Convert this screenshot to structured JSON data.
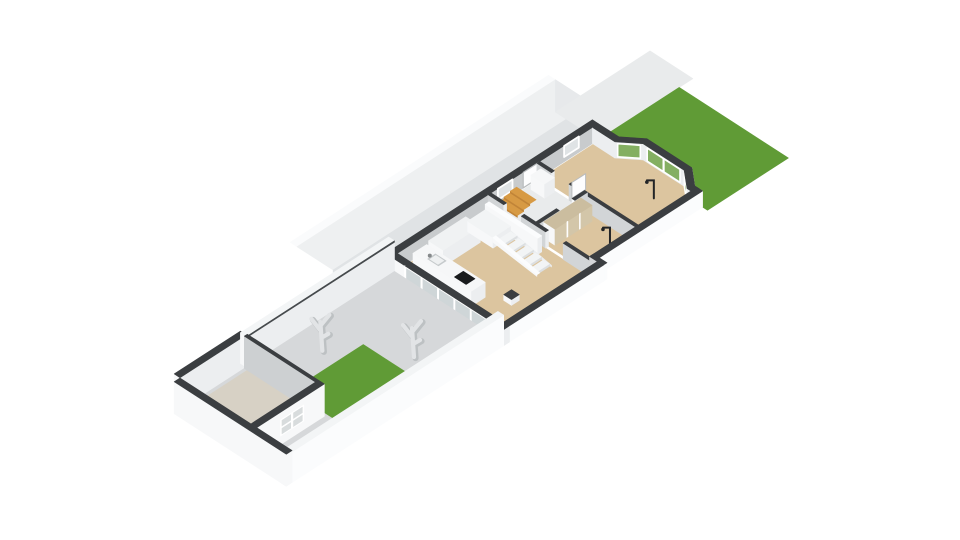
{
  "view": {
    "type": "floorplan-3d-axonometric",
    "background": "#ffffff",
    "projection": "isometric"
  },
  "scene": {
    "trees": 2,
    "gardens": 2
  },
  "palette": {
    "bg": "#ffffff",
    "wallTop": "#3b3e41",
    "wallWhite": "#f7f8f9",
    "wallBright": "#fbfcfd",
    "wallLight": "#eceef0",
    "wallShade": "#d8dadc",
    "wallInterior": "#c8cbcd",
    "wallInteriorLight": "#d2d5d7",
    "floorWood": "#dcc59f",
    "floorShed": "#d7d1c5",
    "floorBath": "#e9ebec",
    "paving": "#d6d8da",
    "lawn": "#609b36",
    "glass": "#cfd6d8",
    "glassPale": "#dfe3e5",
    "glassGreen": "#84af62",
    "shedGlass": "#d8dcdd",
    "counterTop": "#f6f7f8",
    "cabinetTop": "#f0f2f3",
    "cooktop": "#191b1d",
    "sink": "#c6cacc",
    "sinkInner": "#eef0f1",
    "faucet": "#85898b",
    "stairWood": "#d79a44",
    "stairWoodDark": "#c08438",
    "tread": "#f2f4f5",
    "riser": "#dcdfe1",
    "wardrobe": "#d3c6a9",
    "wardrobeTop": "#cbbd9f",
    "roofBand": "#eef0f1",
    "roofFace": "#e0e3e5",
    "roofCap": "#e7e9eb",
    "path": "#e9ebec",
    "treeLight": "#e2e4e6",
    "treeShade": "#bdc1c3",
    "lamp": "#232527",
    "seam": "#45494c",
    "frame": "#ffffff",
    "doorWhite": "#fdfdfe",
    "frameGray": "#b9bcbe",
    "patioWallTopLight": "#f3f5f6",
    "shedWallIn": "#cdd0d2",
    "notchShade": "#d4d6d8",
    "thresholdWhite": "#fafbfc"
  }
}
